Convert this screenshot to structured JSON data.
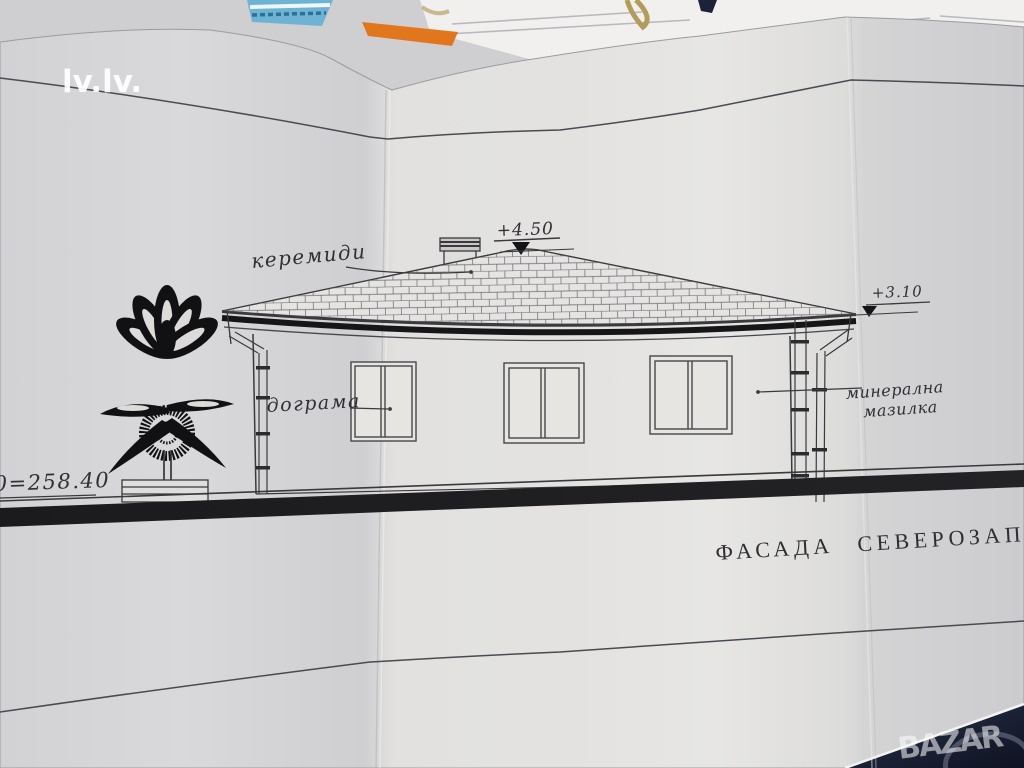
{
  "watermarks": {
    "site_top_left": "lv.lv.",
    "site_bottom_right": "BAZAR"
  },
  "drawing": {
    "title": "ФАСАДА СЕВЕРОЗАПАД",
    "annotations": {
      "roof_tiles": "керемиди",
      "windows": "дограма",
      "plaster_line1": "минерална",
      "plaster_line2": "мазилка"
    },
    "elevation_marks": {
      "ridge": "+4.50",
      "eave": "+3.10",
      "datum": "0=258.40"
    }
  },
  "colors": {
    "paper": "#dedddb",
    "ink": "#3a3a3e",
    "heavy_ink": "#17171a",
    "background_fabric": "#1b2136",
    "blue_booklet": "#6fb3d4",
    "orange_paper": "#e2761c",
    "watermark_white": "#ffffff"
  }
}
